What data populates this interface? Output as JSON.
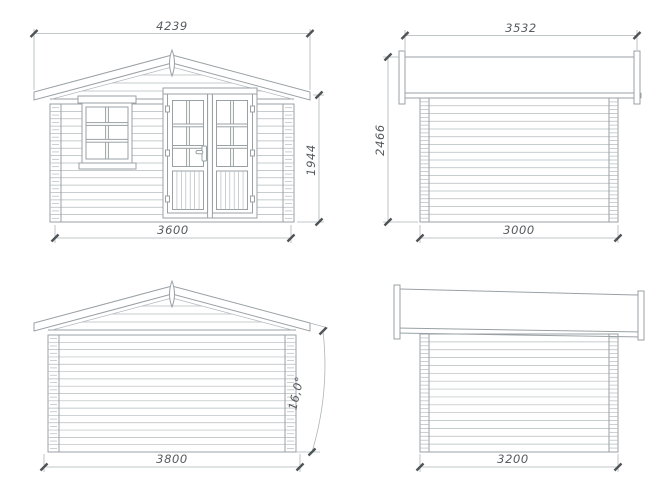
{
  "views": {
    "front": {
      "roof_width_mm": "4239",
      "wall_width_mm": "3600",
      "wall_height_mm": "1944"
    },
    "side_a": {
      "roof_length_mm": "3532",
      "overall_height_mm": "2466",
      "wall_length_mm": "3000"
    },
    "rear": {
      "base_width_mm": "3800",
      "roof_pitch": "16,0°"
    },
    "side_b": {
      "wall_length_mm": "3200"
    }
  },
  "colors": {
    "background": "#ffffff",
    "drawing_line": "#9aa1a4",
    "thin_line": "#b4bbbe",
    "dimension_line": "#aeb5b8",
    "dimension_text": "#565b5f",
    "tick": "#4e5356"
  }
}
